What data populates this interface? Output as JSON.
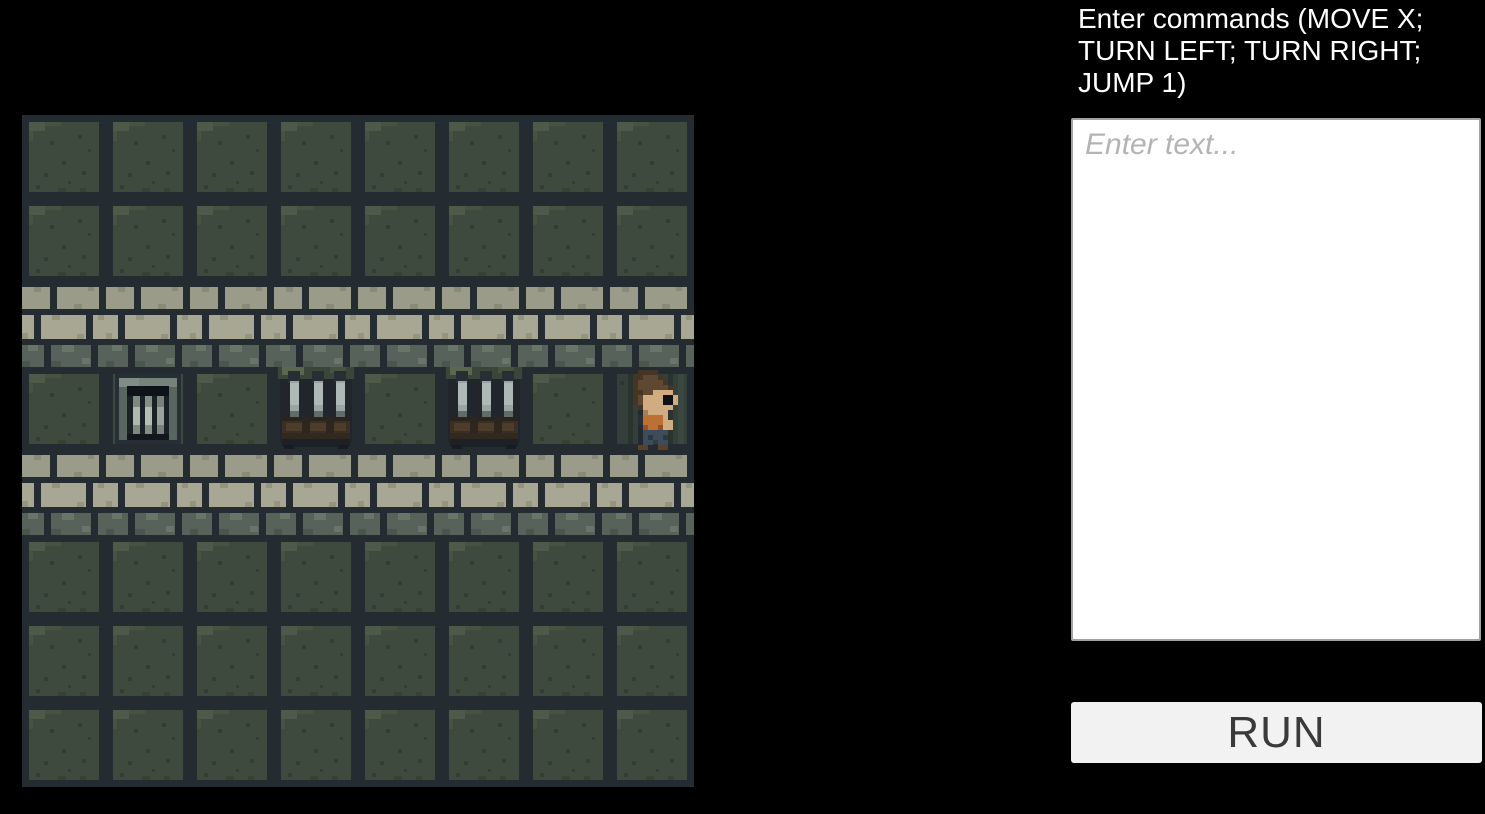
{
  "panel": {
    "instructions": "Enter commands (MOVE X; TURN LEFT; TURN RIGHT; JUMP 1)",
    "input": {
      "placeholder": "Enter text...",
      "value": ""
    },
    "run_label": "RUN"
  },
  "game": {
    "grid": {
      "cols": 8,
      "rows": 8,
      "tile_size": 84
    },
    "legend": {
      "F": "floor",
      "W": "wall",
      "G": "gate",
      "C": "crate",
      "D": "floor-dark"
    },
    "tilemap": [
      "FFFFFFFF",
      "FFFFFFFF",
      "WWWWWWWW",
      "FGFCFCFD",
      "WWWWWWWW",
      "FFFFFFFF",
      "FFFFFFFF",
      "FFFFFFFF"
    ],
    "entities": [
      {
        "type": "player",
        "row": 3,
        "col": 7,
        "facing": "right"
      },
      {
        "type": "gate",
        "row": 3,
        "col": 1
      },
      {
        "type": "crate",
        "row": 3,
        "col": 3
      },
      {
        "type": "crate",
        "row": 3,
        "col": 5
      }
    ],
    "palette": {
      "page_bg": "#000000",
      "grout": "#242c32",
      "floor_green": "#3e4a3d",
      "floor_green_light": "#4d5949",
      "floor_green_dark": "#333d34",
      "floor_dark_tile": "#333f38",
      "brick_light": "#9b9b89",
      "brick_lighter": "#a7a794",
      "brick_dark_course": "#57625b",
      "gate_frame": "#59665f",
      "gate_frame_light": "#75837a",
      "gate_recess": "#1a2127",
      "bar_metal": "#9aa4a3",
      "wood": "#3b2f23",
      "wood_light": "#4e3c2a",
      "player_shirt": "#bd7033",
      "player_skin": "#d2ac81",
      "player_hair": "#5f4831",
      "player_pants": "#3e4b5a",
      "panel_text": "#ffffff",
      "input_bg": "#ffffff",
      "placeholder_color": "#b4b4b4",
      "button_bg": "#f2f2f2",
      "button_text": "#3a3a3a"
    }
  }
}
